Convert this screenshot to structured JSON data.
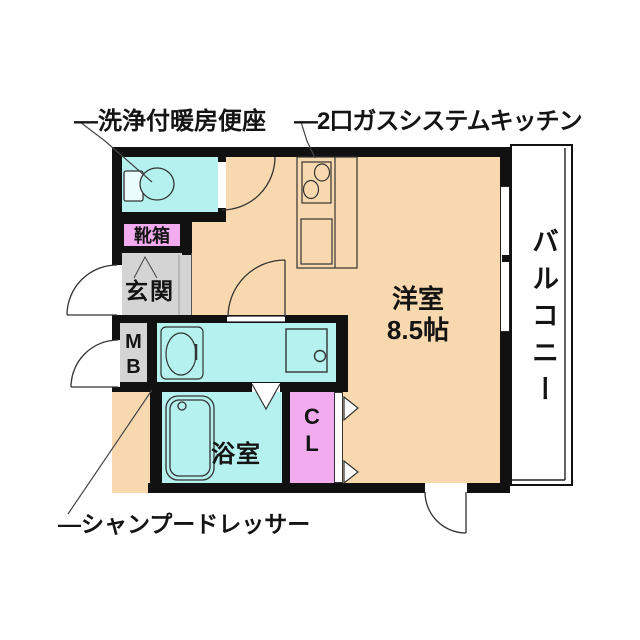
{
  "plan_type": "floorplan",
  "colors": {
    "floor_main": "#f8d9af",
    "floor_wet": "#b4f1ef",
    "floor_pink": "#f2abef",
    "floor_gray": "#d4d4d4",
    "wall": "#111111",
    "background": "#ffffff",
    "line": "#333333"
  },
  "annotations": {
    "toilet_label": "—洗浄付暖房便座",
    "kitchen_label": "—2口ガスシステムキッチン",
    "shampoo_label": "—シャンプードレッサー"
  },
  "rooms": {
    "shoebox": "靴箱",
    "entrance": "玄関",
    "meter_box": {
      "l1": "M",
      "l2": "B"
    },
    "bathroom": "浴室",
    "closet": {
      "l1": "C",
      "l2": "L"
    },
    "western_room": {
      "name": "洋室",
      "size": "8.5帖"
    },
    "balcony": "バルコニー"
  },
  "fixtures": [
    "toilet",
    "kitchen-stove",
    "kitchen-sink",
    "washbasin",
    "washing-machine-pan",
    "bathtub",
    "window",
    "swing-doors",
    "closet-folding-doors"
  ]
}
